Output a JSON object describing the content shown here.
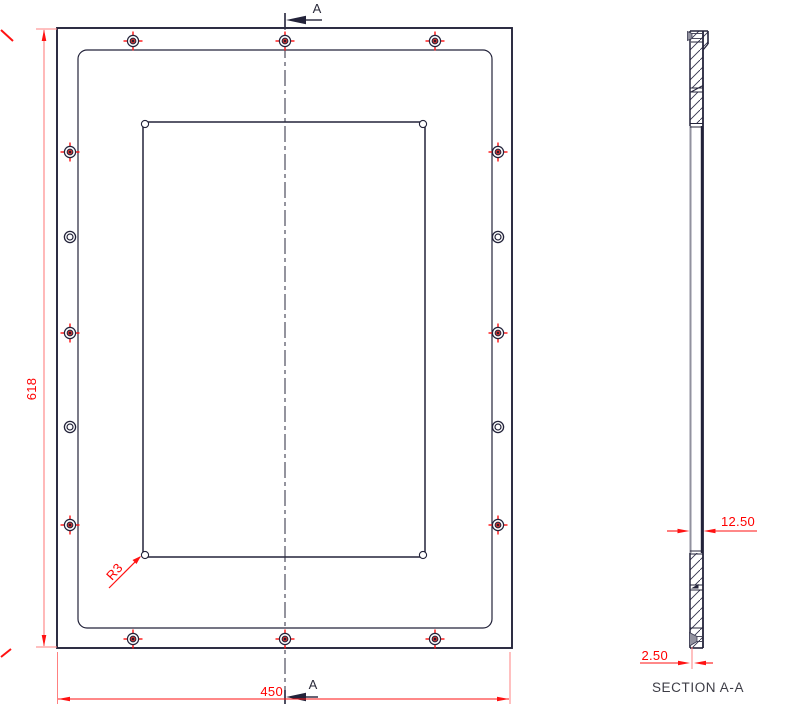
{
  "drawing": {
    "front_view": {
      "dim_height_label": "618",
      "dim_width_label": "450",
      "corner_radius_label": "R3",
      "section_arrow_top_label": "A",
      "section_arrow_bottom_label": "A"
    },
    "section_view": {
      "title": "SECTION A-A",
      "dim_thickness_label": "12.50",
      "dim_wall_label": "2.50"
    },
    "holes": {
      "crosshair": [
        [
          133,
          41
        ],
        [
          285,
          41
        ],
        [
          435,
          41
        ],
        [
          70,
          152
        ],
        [
          498,
          152
        ],
        [
          70,
          333
        ],
        [
          498,
          333
        ],
        [
          70,
          525
        ],
        [
          498,
          525
        ],
        [
          133,
          639
        ],
        [
          285,
          639
        ],
        [
          435,
          639
        ]
      ],
      "plain": [
        [
          70,
          237
        ],
        [
          498,
          237
        ],
        [
          70,
          427
        ],
        [
          498,
          427
        ]
      ]
    },
    "colors": {
      "line": "#23233a",
      "line_soft": "#4a4a60",
      "dim": "#ff1212",
      "dim_light": "#ff8080",
      "gray": "#92929f",
      "hatch": "#30304a"
    }
  }
}
